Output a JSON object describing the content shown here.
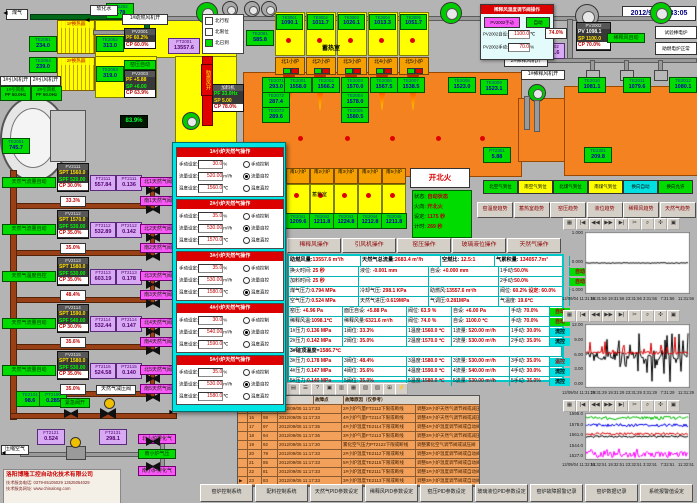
{
  "window": {
    "datetime": "2012/9/5 11:33:05"
  },
  "colors": {
    "background": "#b4b4b4",
    "furnace_orange": "#f58220",
    "duct_yellow": "#ffff00",
    "tag_green": "#00dc00",
    "tag_purple": "#d8aaf4",
    "alarm_row_orange": "#f2a05a",
    "panel_cyan": "#00c8c8",
    "value_red": "#c00000",
    "popup_red": "#dc0000",
    "auto_green": "#00dc00"
  },
  "top_left": {
    "gas_in": "煤气",
    "water_in": "软化水",
    "hx1": "1#换热器",
    "hx2": "2#换热器",
    "fan1_open": "1#助燃风机开",
    "fan2_open": "2#稀释风机开",
    "fan3_open": "1#稀释风机开",
    "idfan_open": [
      "1#引风机开",
      "2#引风机开"
    ],
    "idfan_rows": [
      [
        "1#引风机",
        "PF 50.0Hz"
      ],
      [
        "2#引风机",
        "PF 50.0Hz"
      ]
    ],
    "legend": [
      {
        "label": "北行程",
        "on": false
      },
      {
        "label": "北限位",
        "on": false
      },
      {
        "label": "北已到",
        "on": true
      }
    ],
    "kiln_auto": "窑压自动",
    "damper": "助燃风开",
    "level": "83.9%",
    "regulator": "天然气减压阀",
    "emergency": "紧急阀开",
    "air_in": "压缩空气",
    "branch_air": [
      "北小炉雾化气",
      "南小炉气压",
      "南小炉雾化气"
    ]
  },
  "tags": [
    {
      "id": "FT2202",
      "v": "0.78"
    },
    {
      "id": "TE2061",
      "v": "234.0"
    },
    {
      "id": "TE2062",
      "v": "313.0"
    },
    {
      "id": "TE2064",
      "v": "239.0"
    },
    {
      "id": "TE2063",
      "v": "319.0"
    },
    {
      "id": "TE2081",
      "v": "585.8"
    },
    {
      "id": "FT2001",
      "v": "13557.6"
    },
    {
      "id": "TE2051",
      "v": "745.7"
    },
    {
      "id": "TE2071",
      "v": "293.0"
    },
    {
      "id": "TE2072",
      "v": "287.4"
    },
    {
      "id": "TE2073",
      "v": "289.6"
    },
    {
      "id": "TE2001",
      "v": "1558.0"
    },
    {
      "id": "TE2002",
      "v": "1566.2"
    },
    {
      "id": "TE2003",
      "v": "1570.0"
    },
    {
      "id": "TE2004",
      "v": "1578.0"
    },
    {
      "id": "TE2005",
      "v": "1580.5"
    },
    {
      "id": "TE2006",
      "v": "1567.5"
    },
    {
      "id": "TE2007",
      "v": "1538.5"
    },
    {
      "id": "TE2008",
      "v": "1523.0"
    },
    {
      "id": "TE2009",
      "v": "1523.1"
    },
    {
      "id": "TE2010",
      "v": "1081.1"
    },
    {
      "id": "TE2011",
      "v": "1079.6"
    },
    {
      "id": "TE2012",
      "v": "1080.1"
    },
    {
      "id": "PT2002",
      "v": "6321.6"
    },
    {
      "id": "PT2301",
      "v": "5.88"
    },
    {
      "id": "TE2301",
      "v": "209.8"
    },
    {
      "id": "TE2101",
      "v": "98.6"
    },
    {
      "id": "PT2100",
      "v": "0.285"
    },
    {
      "id": "FT2121",
      "v": "0.524"
    },
    {
      "id": "FT2131",
      "v": "298.1"
    }
  ],
  "ctrls": [
    {
      "id": "PV2001",
      "rows": [
        [
          "PF 60.2%",
          "y"
        ],
        [
          "CP 60.0%",
          "r"
        ]
      ]
    },
    {
      "id": "PV2003",
      "rows": [
        [
          "PF +5.88",
          "y"
        ],
        [
          "SP +6.00",
          "g"
        ],
        [
          "CP 63.9%",
          "r"
        ]
      ]
    },
    {
      "id": "加料机",
      "rows": [
        [
          "PF 33.0Hz",
          "g"
        ],
        [
          "SP 5.00",
          "y"
        ],
        [
          "CP 78.0%",
          "r"
        ]
      ]
    },
    {
      "id": "PV2002",
      "rows": [
        [
          "PV 1098.1",
          "w"
        ],
        [
          "SP 1100.0",
          "y"
        ],
        [
          "CP 70.0%",
          "r"
        ]
      ]
    }
  ],
  "regen": {
    "label_n": "蓄热室",
    "label_s": "蓄热室",
    "north": [
      {
        "tag": "TE3001",
        "v": "1090.1",
        "furnace": "北1小炉"
      },
      {
        "tag": "TE3002",
        "v": "1011.7",
        "furnace": "北2小炉"
      },
      {
        "tag": "TE3003",
        "v": "1026.1",
        "furnace": "北3小炉"
      },
      {
        "tag": "TE3004",
        "v": "1013.3",
        "furnace": "北4小炉"
      },
      {
        "tag": "TE3005",
        "v": "1051.7",
        "furnace": "北5小炉"
      }
    ],
    "south": [
      {
        "furnace": "南1小炉",
        "tag": "TE2041",
        "v": "1209.6"
      },
      {
        "furnace": "南2小炉",
        "tag": "TE2042",
        "v": "1211.8"
      },
      {
        "furnace": "南3小炉",
        "tag": "TE2043",
        "v": "1224.8"
      },
      {
        "furnace": "南4小炉",
        "tag": "TE2044",
        "v": "1212.8"
      },
      {
        "furnace": "南5小炉",
        "tag": "TE2045",
        "v": "1211.8"
      }
    ]
  },
  "gas_train": {
    "rows": [
      {
        "auto": "天然气流量自动",
        "id": "FV2111",
        "rows": [
          [
            "SPT 1560.0",
            "y"
          ],
          [
            "SPF 520.00",
            "g"
          ],
          [
            "CP 30.0%",
            "r"
          ]
        ],
        "ft": "FT2111",
        "ftv": "557.84",
        "pt": "PT2111",
        "ptv": "0.136",
        "pct": "33.3%",
        "bn": "北1天然气阀",
        "bs": "南1天然气阀"
      },
      {
        "auto": "天然气流量自动",
        "id": "FV2112",
        "rows": [
          [
            "SPT 1570.0",
            "y"
          ],
          [
            "SPF 530.00",
            "g"
          ],
          [
            "CP 35.0%",
            "r"
          ]
        ],
        "ft": "FT2112",
        "ftv": "532.89",
        "pt": "PT2112",
        "ptv": "0.142",
        "pct": "35.0%",
        "bn": "北2天然气阀",
        "bs": "南2天然气阀"
      },
      {
        "auto": "天然气温度自控",
        "id": "FV2113",
        "rows": [
          [
            "SPT 1580.0",
            "y"
          ],
          [
            "SPF 530.00",
            "g"
          ],
          [
            "CP 35.0%",
            "r"
          ]
        ],
        "ft": "FT2113",
        "ftv": "603.19",
        "pt": "PT2113",
        "ptv": "0.178",
        "pct": "48.4%",
        "bn": "北3天然气阀",
        "bs": "南3天然气阀"
      },
      {
        "auto": "天然气流量自动",
        "id": "FV2114",
        "rows": [
          [
            "SPT 1590.0",
            "y"
          ],
          [
            "SPF 540.00",
            "g"
          ],
          [
            "CP 30.0%",
            "r"
          ]
        ],
        "ft": "FT2114",
        "ftv": "532.44",
        "pt": "PT2114",
        "ptv": "0.147",
        "pct": "35.6%",
        "bn": "北4天然气阀",
        "bs": "南4天然气阀"
      },
      {
        "auto": "天然气流量自动",
        "id": "FV2115",
        "rows": [
          [
            "SPT 1580.0",
            "y"
          ],
          [
            "SPF 530.00",
            "g"
          ],
          [
            "CP 35.0%",
            "r"
          ]
        ],
        "ft": "FT2115",
        "ftv": "524.58",
        "pt": "PT2115",
        "ptv": "0.140",
        "pct": "35.0%",
        "bn": "北5天然气阀",
        "bs": "南5天然气阀"
      }
    ]
  },
  "dilution_popup": {
    "title": "稀释风温度调节阀操作",
    "manual_btn": "PV2002手动",
    "auto_btn": "自动",
    "rows": [
      [
        "PV2002自设:",
        "1100.0",
        "℃"
      ],
      [
        "PV2002手动:",
        "70.0",
        "%"
      ]
    ],
    "valve_pos": "74.0%",
    "auto_label": "稀释风自动"
  },
  "right_buttons": [
    "试验棒电炉",
    "助燃电炉正常"
  ],
  "fire": {
    "button": "开北火",
    "rows": [
      [
        "状态:",
        "自动状态"
      ],
      [
        "火向:",
        "开北火"
      ],
      [
        "设定:",
        "1175 秒"
      ],
      [
        "计时:",
        "269 秒"
      ]
    ]
  },
  "status_chips": [
    {
      "label": "北空气到位",
      "c": "g"
    },
    {
      "label": "南空气到位",
      "c": "y"
    },
    {
      "label": "北煤气到位",
      "c": "g"
    },
    {
      "label": "南煤气到位",
      "c": "y"
    },
    {
      "label": "换向自动",
      "c": "c"
    },
    {
      "label": "换向允许",
      "c": "g"
    }
  ],
  "trend_buttons": [
    "窑温度趋势",
    "蓄热室趋势",
    "窑压趋势",
    "液位趋势",
    "稀释风趋势",
    "天然气趋势"
  ],
  "op_buttons": [
    "稀释风操作",
    "引风机操作",
    "窑压操作",
    "玻璃液位操作",
    "天然气操作"
  ],
  "data_panel": {
    "header": [
      "助燃风量:13557.6 m³/h",
      "天然气总流量:2683.4 m³/h",
      "空燃比: 12.5:1",
      "气累积量: 134057.7m³"
    ],
    "rows": [
      {
        "cells": [
          "换火时间: 25 秒",
          "液位: -0.001 mm",
          "自设: +0.000 mm",
          "1手动:50.0%"
        ],
        "status": "自动"
      },
      {
        "cells": [
          "加料时间: 25 秒",
          "",
          "",
          "2手动:50.0%"
        ],
        "status": "自动"
      },
      {
        "cells": [
          "煤气压力:0.794 MPa",
          "冷却气压: 298.1 KPa",
          "助燃风:13557.6 m³/h",
          "阀位: 60.2% 设定: 60.0%"
        ],
        "status": null
      },
      {
        "cells": [
          "空气压力:0.524 MPa",
          "天然气进压:0.619MPa",
          "气调压:0.281MPa",
          "气温度: 19.6℃"
        ],
        "status": null
      },
      {
        "cells": [
          "窑压: +6.96 Pa",
          "面压自设: +5.88 Pa",
          "阀位: 63.9 %",
          "自设: +6.00 Pa",
          "手动: 70.0%"
        ],
        "status": "自动"
      },
      {
        "cells": [
          "稀释风温:1098.1℃",
          "稀释风量:6321.6 m³/h",
          "阀位: 74.0 %",
          "自设: 1100.0 ℃",
          "手动: 70.0%"
        ],
        "status": "自动"
      },
      {
        "cells": [
          "1#压力:0.136 MPa",
          "1阀位: 33.3%",
          "1温度:1560.0 ℃",
          "1流量: 520.00 m³/h",
          "1手动: 30.0%"
        ],
        "status": "流控"
      },
      {
        "cells": [
          "2#压力:0.142 MPa",
          "2阀位: 35.0%",
          "2温度:1570.0 ℃",
          "2流量: 530.00 m³/h",
          "2手动: 35.0%"
        ],
        "status": "流控"
      },
      {
        "span": "3#碹顶温度=1586.7℃"
      },
      {
        "cells": [
          "3#压力:0.178 MPa",
          "3阀位: 48.4%",
          "3温度:1580.0 ℃",
          "3流量: 530.00 m³/h",
          "3手动: 35.0%"
        ],
        "status": "温控"
      },
      {
        "cells": [
          "4#压力:0.147 MPa",
          "4阀位: 35.6%",
          "4温度:1590.0 ℃",
          "4流量: 540.00 m³/h",
          "4手动: 30.0%"
        ],
        "status": "流控"
      },
      {
        "cells": [
          "5#压力:0.140 MPa",
          "5阀位: 35.0%",
          "5温度:1580.0 ℃",
          "5流量: 530.00 m³/h",
          "5手动: 35.0%"
        ],
        "status": "流控"
      }
    ]
  },
  "gas_popup": {
    "panels": [
      {
        "title": "1#小炉天然气操作",
        "rows": [
          [
            "手动设定:",
            "30.0",
            "%"
          ],
          [
            "流量设定:",
            "520.00",
            "m³/h"
          ],
          [
            "温度设定:",
            "1560.0",
            "℃"
          ]
        ],
        "radios": [
          "手动控制",
          "流量自控",
          "温度直控"
        ],
        "selected": 1
      },
      {
        "title": "2#小炉天然气操作",
        "rows": [
          [
            "手动设定:",
            "35.0",
            "%"
          ],
          [
            "流量设定:",
            "530.00",
            "m³/h"
          ],
          [
            "温度设定:",
            "1570.0",
            "℃"
          ]
        ],
        "radios": [
          "手动控制",
          "流量自控",
          "温度直控"
        ],
        "selected": 1
      },
      {
        "title": "3#小炉天然气操作",
        "rows": [
          [
            "手动设定:",
            "35.0",
            "%"
          ],
          [
            "流量设定:",
            "530.00",
            "m³/h"
          ],
          [
            "温度设定:",
            "1580.0",
            "℃"
          ]
        ],
        "radios": [
          "手动控制",
          "流量自控",
          "温度直控"
        ],
        "selected": 2
      },
      {
        "title": "4#小炉天然气操作",
        "rows": [
          [
            "手动设定:",
            "30.0",
            "%"
          ],
          [
            "流量设定:",
            "540.00",
            "m³/h"
          ],
          [
            "温度设定:",
            "1590.0",
            "℃"
          ]
        ],
        "radios": [
          "手动控制",
          "流量自控",
          "温度直控"
        ],
        "selected": 1
      },
      {
        "title": "5#小炉天然气操作",
        "rows": [
          [
            "手动设定:",
            "35.0",
            "%"
          ],
          [
            "流量设定:",
            "530.00",
            "m³/h"
          ],
          [
            "温度设定:",
            "1580.0",
            "℃"
          ]
        ],
        "radios": [
          "手动控制",
          "流量自控",
          "温度直控"
        ],
        "selected": 1
      }
    ]
  },
  "alarm": {
    "headers": [
      "故障点",
      "故障原因（仅参考）"
    ],
    "rows": [
      [
        "15",
        "96",
        "2012/09/05",
        "11:17:33",
        "2#小炉气量FT2112下限或断线",
        "调整2#小炉天然气调节阀或减压阀"
      ],
      [
        "16",
        "98",
        "2012/09/05",
        "11:17:33",
        "4#小炉气量FT2114下限或断线",
        "调整4#小炉天然气调节阀或减压阀"
      ],
      [
        "17",
        "97",
        "2012/09/05",
        "11:17:35",
        "4#小炉温度TE2114下限或断线",
        "调整4#小炉温度调节阀或自动阀"
      ],
      [
        "18",
        "94",
        "2012/09/05",
        "11:17:36",
        "3#小炉气量FT2113下限或断线",
        "调整3#小炉天然气调节阀或减压阀"
      ],
      [
        "19",
        "92",
        "2012/09/05",
        "11:17:30",
        "雾化空气压力PT2122下限或断线",
        "调整雾化空气调节阀或减压阀"
      ],
      [
        "20",
        "79",
        "2012/09/05",
        "11:17:33",
        "2#小炉温度TE2112下限或断线",
        "调整2#小炉温度调节阀或自动阀"
      ],
      [
        "21",
        "85",
        "2012/09/05",
        "11:17:33",
        "5#小炉温度TE2115下限或断线",
        "调整5#小炉温度调节阀或自动阀"
      ],
      [
        "22",
        "81",
        "2012/09/05",
        "11:17:33",
        "1#小炉温度TE2111下限或断线",
        "调整1#小炉温度调节阀或自动阀"
      ],
      [
        "23",
        "83",
        "2012/09/05",
        "11:17:33",
        "3#小炉温度TE2113下限或断线",
        "调整3#小炉温度调节阀或自动阀"
      ]
    ]
  },
  "alarm_toolbar": [
    "▤",
    "☰",
    "?",
    "▣",
    "▥",
    "▦",
    "▧",
    "▨",
    "⊞",
    "⚡"
  ],
  "chart_toolbar": [
    "▦",
    "|◀",
    "◀◀",
    "▶▶",
    "▶|",
    "✂",
    "⌕",
    "✣",
    "▣"
  ],
  "chart_data": [
    {
      "type": "line",
      "title": "玻璃液位趋势",
      "yticks": [
        "1.000",
        "0.000",
        "-1.000"
      ],
      "ylim": [
        -1,
        1
      ],
      "x_labels": [
        "12/09/04 11:31:56",
        "15:31:56",
        "19:31:56",
        "23:31:56",
        "3:31:56",
        "7:31:56",
        "11:31:56"
      ],
      "grid": false,
      "legend": "none",
      "series": [
        {
          "name": "black-line",
          "color": "#000000",
          "mean": 0,
          "amp": 0.015,
          "spike_p": 0,
          "spike_lo": 0,
          "spike_hi": 0
        }
      ]
    },
    {
      "type": "line",
      "title": "窑压趋势",
      "yticks": [
        "12.00",
        "9.00",
        "6.00",
        "3.00",
        "0.00"
      ],
      "ylim": [
        0,
        12
      ],
      "x_labels": [
        "12/09/04 11:31:29",
        "15:31:29",
        "19:31:29",
        "23:31:29",
        "3:31:29",
        "7:31:29",
        "11:31:29"
      ],
      "grid": false,
      "legend": "none",
      "series": [
        {
          "name": "black-line",
          "color": "#000000",
          "mean": 6.0,
          "amp": 0.8,
          "spike_p": 0.3,
          "spike_lo": 0.3,
          "spike_hi": 10.8
        },
        {
          "name": "red-line",
          "color": "#dd0000",
          "mean": 6.6,
          "amp": 0.3,
          "spike_p": 0.1,
          "spike_lo": 6.6,
          "spike_hi": 9.8
        }
      ]
    },
    {
      "type": "line",
      "title": "小炉温度趋势",
      "yticks": [
        "1595.0",
        "1578.0",
        "1561.0",
        "1544.0",
        "1527.0"
      ],
      "ylim": [
        1527,
        1595
      ],
      "x_labels": [
        "12/09/04 11:32:51",
        "15:32:51",
        "19:32:51",
        "23:32:51",
        "3:32:51",
        "7:32:51",
        "11:32:51"
      ],
      "grid": false,
      "legend": "none",
      "series": [
        {
          "name": "magenta-line",
          "color": "#ff00ff",
          "mean": 1534,
          "amp": 5,
          "spike_p": 0.15,
          "spike_lo": 1528,
          "spike_hi": 1543
        },
        {
          "name": "black-line",
          "color": "#000000",
          "mean": 1561,
          "amp": 1.5,
          "spike_p": 0,
          "spike_lo": 0,
          "spike_hi": 0
        },
        {
          "name": "red-line",
          "color": "#dd0000",
          "mean": 1565,
          "amp": 1.8,
          "spike_p": 0,
          "spike_lo": 0,
          "spike_hi": 0
        },
        {
          "name": "blue-line",
          "color": "#0000ee",
          "mean": 1578,
          "amp": 2.2,
          "spike_p": 0,
          "spike_lo": 0,
          "spike_hi": 0
        },
        {
          "name": "green-line",
          "color": "#00bb00",
          "mean": 1589,
          "amp": 2.5,
          "spike_p": 0,
          "spike_lo": 0,
          "spike_hi": 0
        }
      ]
    }
  ],
  "bottom_buttons": [
    "窑炉控制系统",
    "配料控制系统",
    "天然气PID参数设定",
    "稀释风PID参数设定",
    "窑压PID参数设定",
    "玻璃液位PID参数设定",
    "窑炉故障报警记录",
    "窑炉数据记录",
    "系统报警值设定"
  ],
  "company": {
    "name": "洛阳博隆工控自动化技术有限公司",
    "line1": "技术服务电话: 0379-65105029  13525054029",
    "line2": "技术服务网址: www.chinalong.com"
  }
}
